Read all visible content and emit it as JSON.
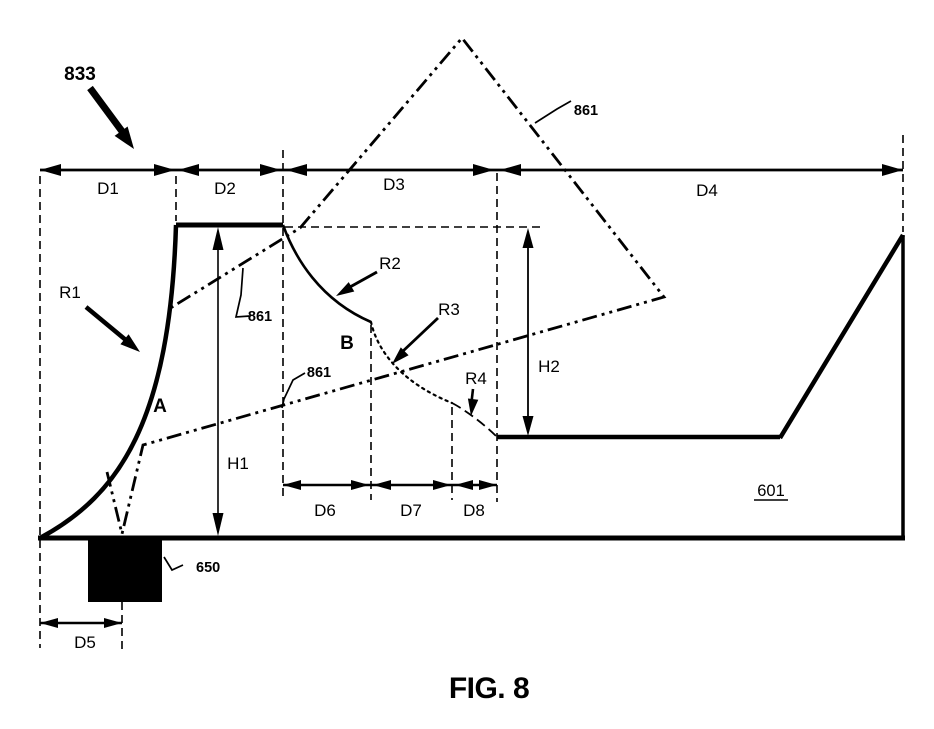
{
  "figure": {
    "caption": "FIG. 8",
    "background": "#ffffff",
    "ink_color": "#000000"
  },
  "reference_numerals": {
    "pointer_833": "833",
    "phantom_861": "861",
    "insert_650": "650",
    "body_601": "601"
  },
  "dimensions": {
    "d1": "D1",
    "d2": "D2",
    "d3": "D3",
    "d4": "D4",
    "d5": "D5",
    "d6": "D6",
    "d7": "D7",
    "d8": "D8"
  },
  "heights": {
    "h1": "H1",
    "h2": "H2"
  },
  "radii": {
    "r1": "R1",
    "r2": "R2",
    "r3": "R3",
    "r4": "R4"
  },
  "points": {
    "a": "A",
    "b": "B"
  }
}
